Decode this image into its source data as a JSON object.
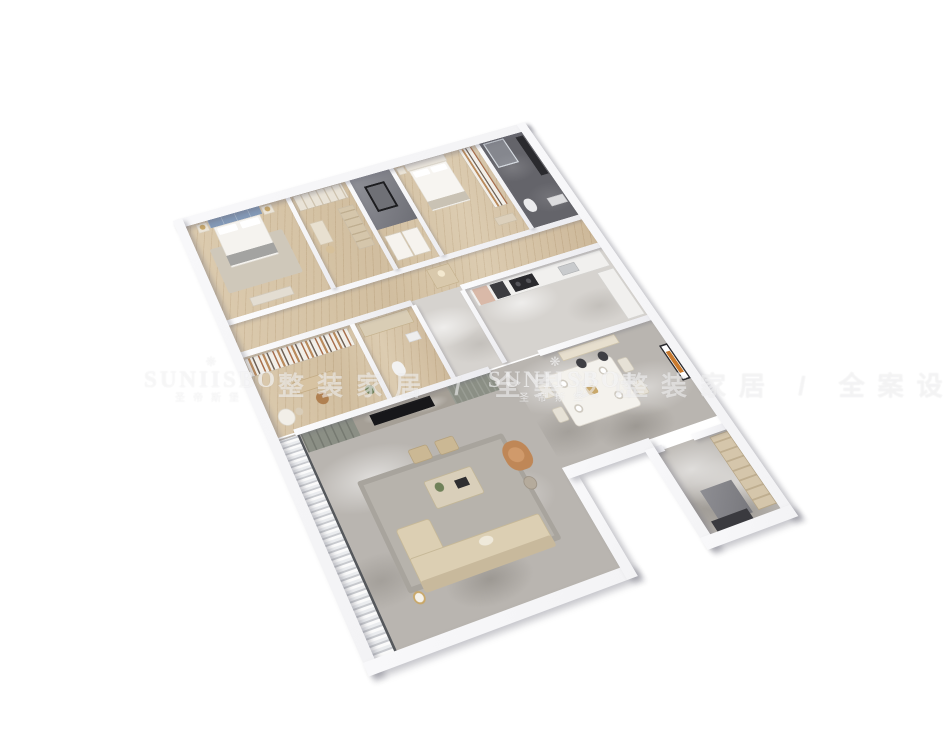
{
  "scene": {
    "type": "3d-isometric-floorplan-render",
    "description": "Photorealistic dollhouse-style 3D floor plan of an apartment on a white background",
    "rooms": [
      "master bedroom with blue panelled headboard bed",
      "walk-in closet with wardrobes and vanity",
      "grey elevator shaft / feature wall",
      "second bedroom with cream bed and shelving",
      "dark marble bathroom with glass shower",
      "study with bookshelf wall, desk and reading table",
      "hallway with arched niche cabinet",
      "kitchen with cooktop, ovens and U-shaped counter",
      "dining room with marble table, chairs, bar counter and wall art",
      "living room with TV wall, sofa, coffee table, ottomans and accent chair",
      "balcony with sheer curtains",
      "entry hall wing with full-height cabinets"
    ]
  },
  "watermark": {
    "ornament_glyph": "❋",
    "brand": "SUNIISBO",
    "brand_chinese": "圣帝斯堡",
    "slogan": "整装家居 / 全案设计"
  },
  "colors": {
    "wall": "#f3f3f5",
    "floor_marble": "#b9b5b0",
    "floor_marble_light": "#d6d3cf",
    "floor_wood": "#d3bfa0",
    "floor_dark": "#64646a",
    "headboard_blue": "#8399b7",
    "sofa_beige": "#dccfb3",
    "accent_chair": "#bf8757",
    "cabinet_olive": "#8b8f85",
    "counter_white": "#f1f0ee",
    "appliance_dark": "#2a2a2e",
    "rug_gray": "#b7b3ac",
    "wood_furniture": "#d7c3a2",
    "greenery": "#6f8159",
    "brass": "#c9a86a",
    "artwork_orange": "#c97a2e"
  }
}
